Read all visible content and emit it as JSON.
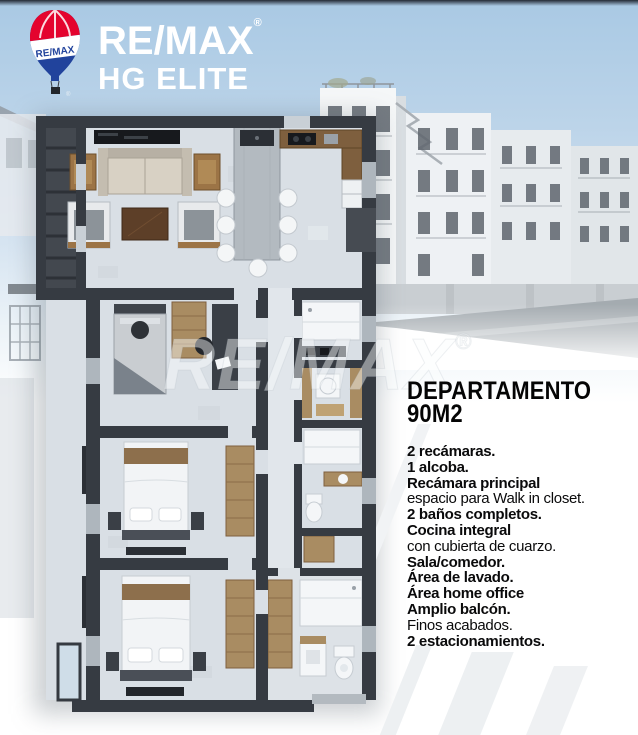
{
  "brand": {
    "name": "RE/MAX",
    "registered": "®",
    "sub": "HG ELITE",
    "balloon_label": "RE/MAX"
  },
  "watermark": {
    "text": "RE/MAX",
    "registered": "®"
  },
  "listing": {
    "title_line1": "DEPARTAMENTO",
    "title_line2": "90M2",
    "features": [
      {
        "text": "2 recámaras.",
        "bold": true
      },
      {
        "text": "1 alcoba.",
        "bold": true
      },
      {
        "text": "Recámara principal",
        "bold": true
      },
      {
        "text": "espacio para Walk in closet.",
        "bold": false
      },
      {
        "text": "2 baños completos.",
        "bold": true
      },
      {
        "text": "Cocina integral",
        "bold": true
      },
      {
        "text": "con cubierta de cuarzo.",
        "bold": false
      },
      {
        "text": "Sala/comedor.",
        "bold": true
      },
      {
        "text": "Área de lavado.",
        "bold": true
      },
      {
        "text": "Área home office",
        "bold": true
      },
      {
        "text": "Amplio balcón.",
        "bold": true
      },
      {
        "text": "Finos acabados.",
        "bold": false
      },
      {
        "text": "2 estacionamientos.",
        "bold": true
      }
    ]
  },
  "floor_plan": {
    "alt": "3D top-down floor plan of a 90 m2 apartment with living-dining room, kitchen, two bedrooms, home-office alcove, two bathrooms, laundry area and side balcony"
  },
  "background": {
    "alt": "Render of white apartment buildings under a light blue sky"
  },
  "colors": {
    "remax_red": "#e4032e",
    "remax_blue": "#1b3f94",
    "sky_blue": "#aecbe4",
    "plan_wall": "#363b42",
    "plan_floor": "#d9dfe5",
    "wood": "#a98c62",
    "text_black": "#0a0a0b",
    "white": "#ffffff"
  }
}
